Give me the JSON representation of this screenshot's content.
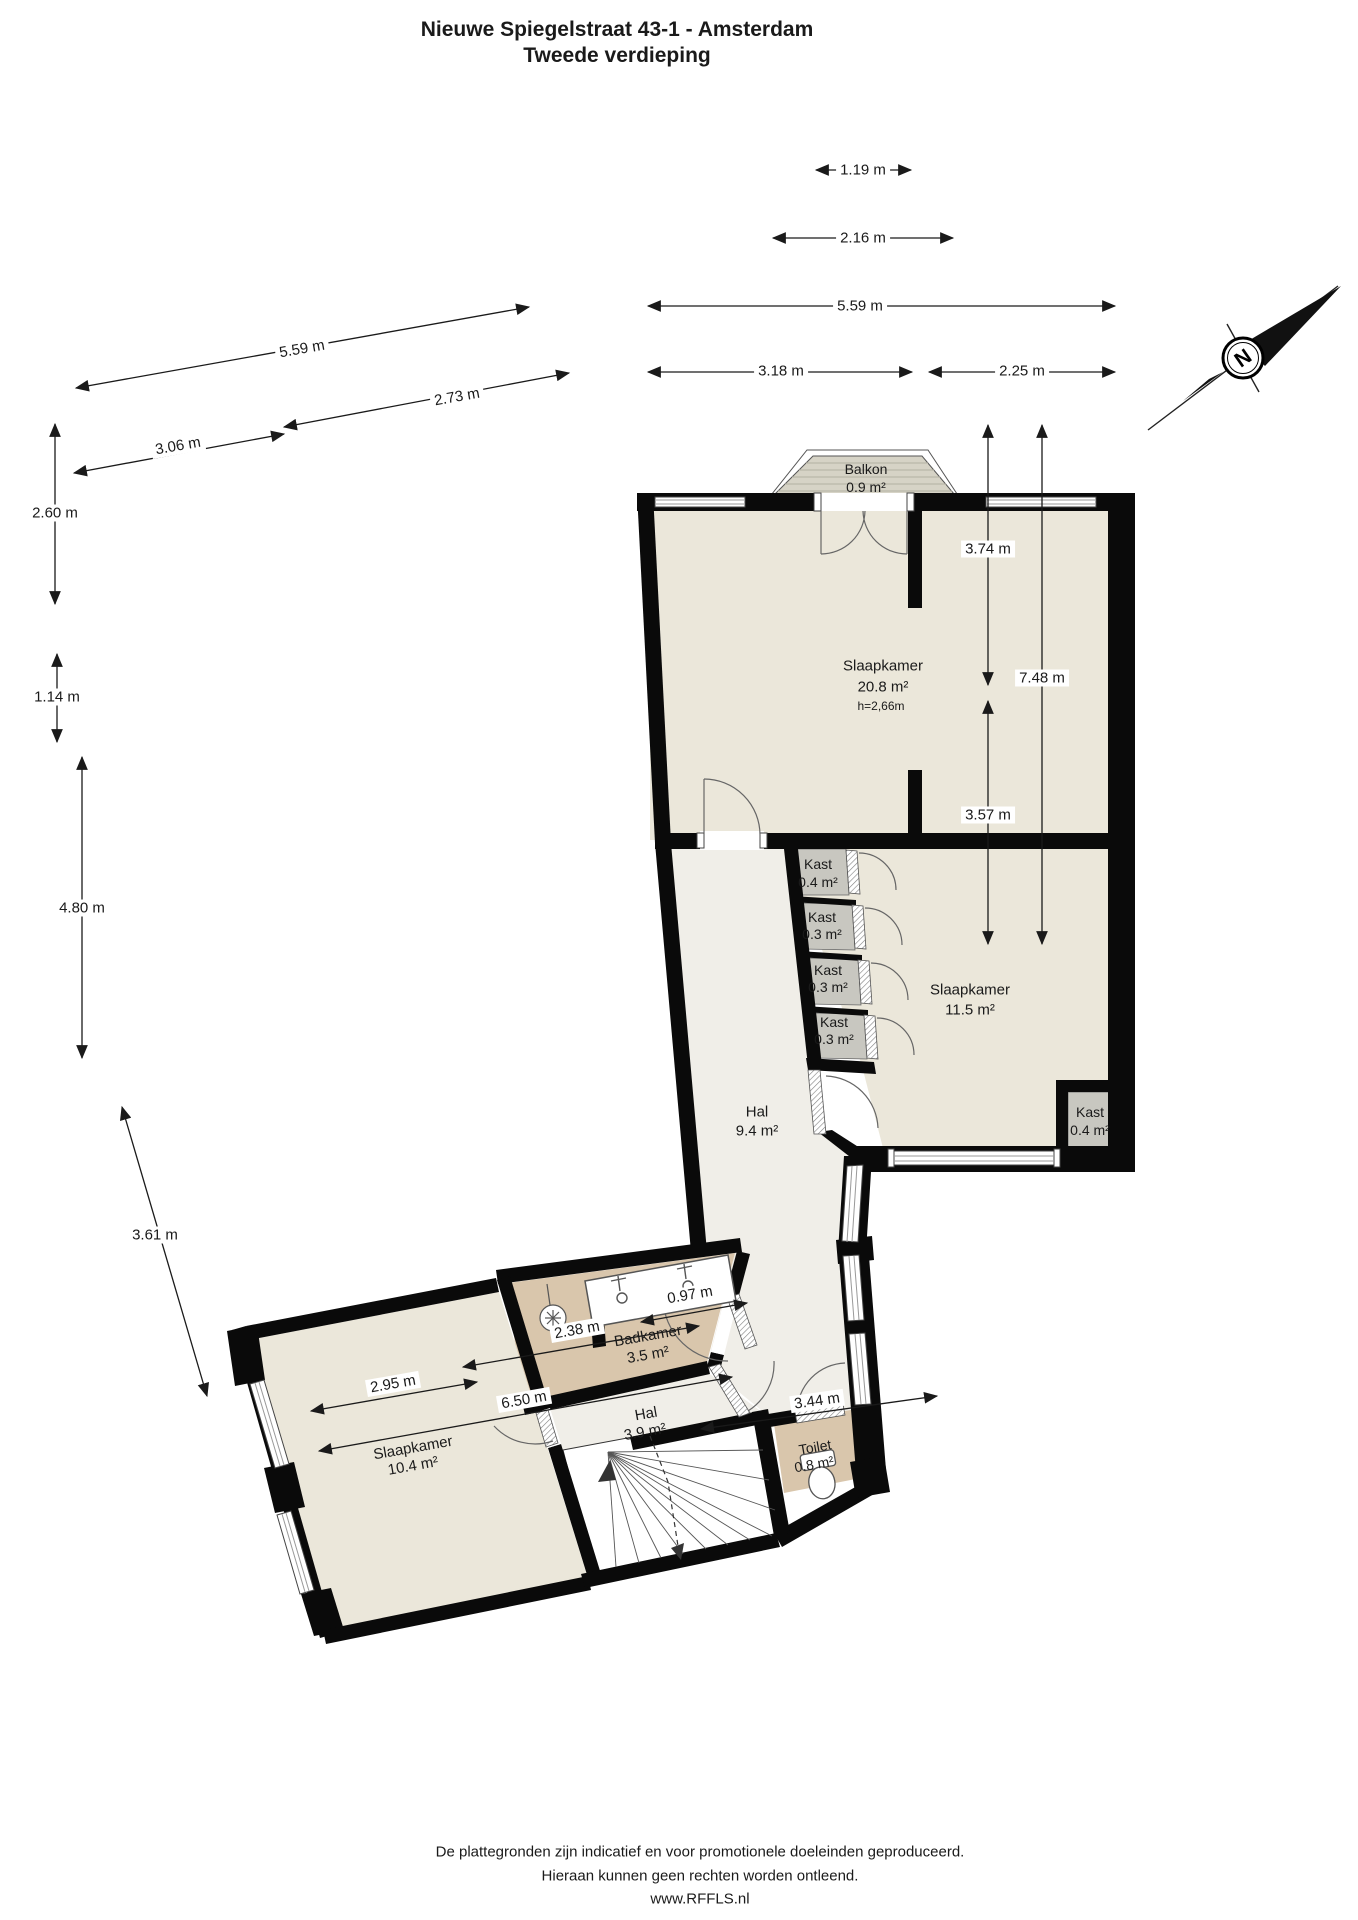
{
  "title": {
    "line1": "Nieuwe Spiegelstraat 43-1 - Amsterdam",
    "line2": "Tweede verdieping"
  },
  "compass": {
    "letter": "N"
  },
  "rooms": {
    "balkon": {
      "name": "Balkon",
      "area": "0.9 m²"
    },
    "slaapkamer1": {
      "name": "Slaapkamer",
      "area": "20.8 m²",
      "ceiling": "h=2,66m"
    },
    "kast1": {
      "name": "Kast",
      "area": "0.4 m²"
    },
    "kast2": {
      "name": "Kast",
      "area": "0.3 m²"
    },
    "kast3": {
      "name": "Kast",
      "area": "0.3 m²"
    },
    "kast4": {
      "name": "Kast",
      "area": "0.3 m²"
    },
    "slaapkamer2": {
      "name": "Slaapkamer",
      "area": "11.5 m²"
    },
    "kast5": {
      "name": "Kast",
      "area": "0.4 m²"
    },
    "hal1": {
      "name": "Hal",
      "area": "9.4 m²"
    },
    "badkamer": {
      "name": "Badkamer",
      "area": "3.5 m²"
    },
    "hal2": {
      "name": "Hal",
      "area": "3.9 m²"
    },
    "toilet": {
      "name": "Toilet",
      "area": "0.8 m²"
    },
    "slaapkamer3": {
      "name": "Slaapkamer",
      "area": "10.4 m²"
    }
  },
  "dims": {
    "t1": "1.19 m",
    "t2": "2.16 m",
    "t3": "5.59 m",
    "t4": "3.18 m",
    "t5": "2.25 m",
    "l1": "5.59 m",
    "l2": "2.73 m",
    "l3": "3.06 m",
    "v1": "2.60 m",
    "v2": "1.14 m",
    "v3": "4.80 m",
    "v4": "3.61 m",
    "r1": "3.74 m",
    "r2": "7.48 m",
    "r3": "3.57 m",
    "b1": "0.97 m",
    "b2": "2.38 m",
    "b3": "2.95 m",
    "b4": "6.50 m",
    "b5": "3.44 m"
  },
  "footer": {
    "line1": "De plattegronden zijn indicatief en voor promotionele doeleinden geproduceerd.",
    "line2": "Hieraan kunnen geen rechten worden ontleend.",
    "line3": "www.RFFLS.nl"
  },
  "colors": {
    "wall": "#0a0a0a",
    "bedroom_fill": "#ebe7da",
    "hall_fill": "#f0eee8",
    "bathroom_fill": "#d9c6ac",
    "closet_fill": "#c8c7c0",
    "balcony_fill": "#d6d3c6",
    "dimension_text": "#1a1a1a"
  }
}
